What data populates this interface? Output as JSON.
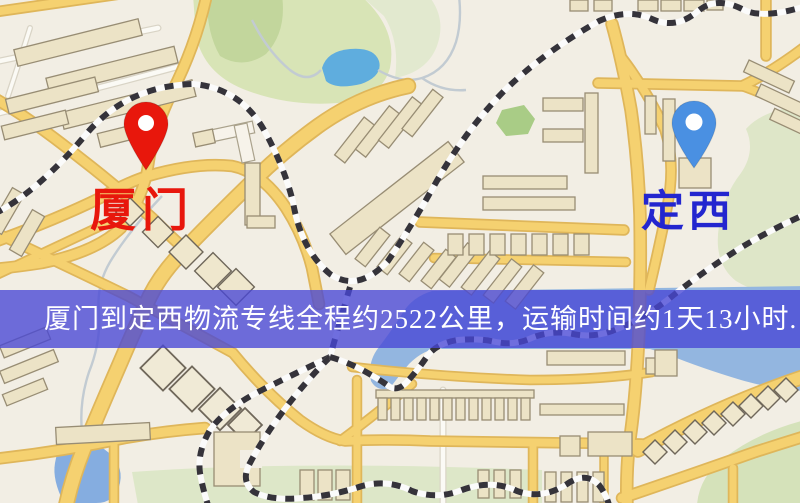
{
  "banner": {
    "text": "厦门到定西物流专线全程约2522公里，运输时间约1天13小时.",
    "background": "#4846d6",
    "text_color": "#ffffff"
  },
  "markers": {
    "origin": {
      "label": "厦门",
      "pin_color": "#e8170c",
      "label_color": "#e8170c"
    },
    "destination": {
      "label": "定西",
      "pin_color": "#4a90e2",
      "label_color": "#2326cf"
    }
  },
  "palette": {
    "map_background": "#f2eee4",
    "road_fill": "#f5d170",
    "road_casing": "#dfb65a",
    "building_fill": "#ece3c6",
    "building_outline": "#988d74",
    "park_green": "#d8e4b6",
    "water_blue": "#93b6e0",
    "lake_blue": "#5fadde",
    "railway_dark": "#35333a",
    "railway_light": "#fbfbfb"
  }
}
